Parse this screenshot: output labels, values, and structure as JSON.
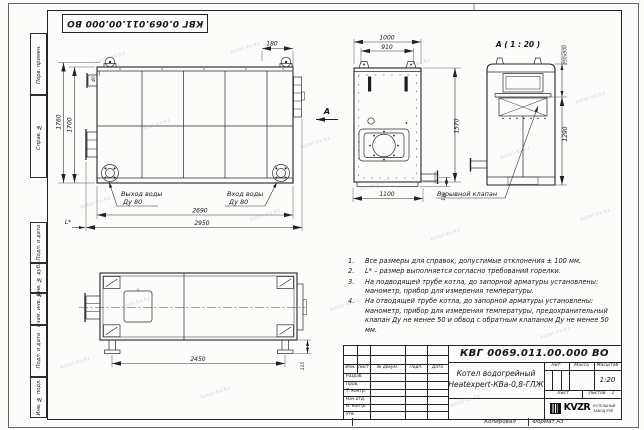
{
  "stamp": {
    "doc_number": "КВГ 0.069.011.00.000 ВО"
  },
  "frame": {
    "margin_fields": [
      "Перв. примен.",
      "Справ. №",
      "Подп. и дата",
      "Инв. № дубл.",
      "Взам. инв. №",
      "Подп. и дата",
      "Инв. № подл."
    ]
  },
  "watermark": {
    "text": "kotel-kv.kz"
  },
  "notes": {
    "items": [
      {
        "num": "1.",
        "text": "Все размеры для справок, допустимые отклонения ± 100 мм."
      },
      {
        "num": "2.",
        "text": "L* – размер выполняется согласно требований горелки."
      },
      {
        "num": "3.",
        "text": "На подводящей трубе котла, до запорной арматуры установлены: манометр, прибор для измерения температуры."
      },
      {
        "num": "4.",
        "text": "На отводящей трубе котла, до запорной арматуры установлены: манометр, прибор для измерения температуры, предохранительный клапан Ду не менее 50 и обвод с обратным клапаном Ду не менее 50 мм."
      }
    ]
  },
  "views": {
    "side": {
      "dim_180": "180",
      "dim_1760": "1760",
      "dim_1700": "1700",
      "dim_40": "40",
      "dim_2690": "2690",
      "dim_2950": "2950",
      "dim_l": "L*",
      "outlet_name": "Выход воды",
      "outlet_dn": "Ду 80",
      "inlet_name": "Вход воды",
      "inlet_dn": "Ду 80"
    },
    "front": {
      "dim_1000": "1000",
      "dim_910": "910",
      "dim_1570": "1570",
      "dim_1100": "1100",
      "dim_115": "115",
      "arrow_label": "А"
    },
    "detail": {
      "title": "А ( 1 : 20 )",
      "dim_opening": "250х500",
      "dim_1290": "1290",
      "valve_label": "Взрывной клапан"
    },
    "top": {
      "dim_2450": "2450",
      "dim_115": "115"
    }
  },
  "title_block": {
    "doc_number": "КВГ 0069.011.00.000 ВО",
    "product_name_line1": "Котел водогрейный",
    "product_name_line2": "Heatexpert-КВа-0,8-ГЛЖ",
    "columns": {
      "izm": "Изм.",
      "list": "Лист",
      "doc": "№ докум.",
      "podp": "Подп.",
      "data": "Дата"
    },
    "roles": [
      "Разраб.",
      "Пров.",
      "Т. контр.",
      "Нач.отд.",
      "Н. контр.",
      "Утв."
    ],
    "lit_label": "Лит.",
    "mass_label": "Масса",
    "scale_label": "Масштаб",
    "scale_value": "1:20",
    "sheet_label": "Лист",
    "sheets_label": "Листов",
    "sheets_value": "1",
    "logo_text": "KVZR",
    "company_line1": "КОТЕЛЬНЫЙ",
    "company_line2": "ЗАВОД РЭП"
  },
  "footer": {
    "copied": "Копировал",
    "format": "Формат А3"
  }
}
